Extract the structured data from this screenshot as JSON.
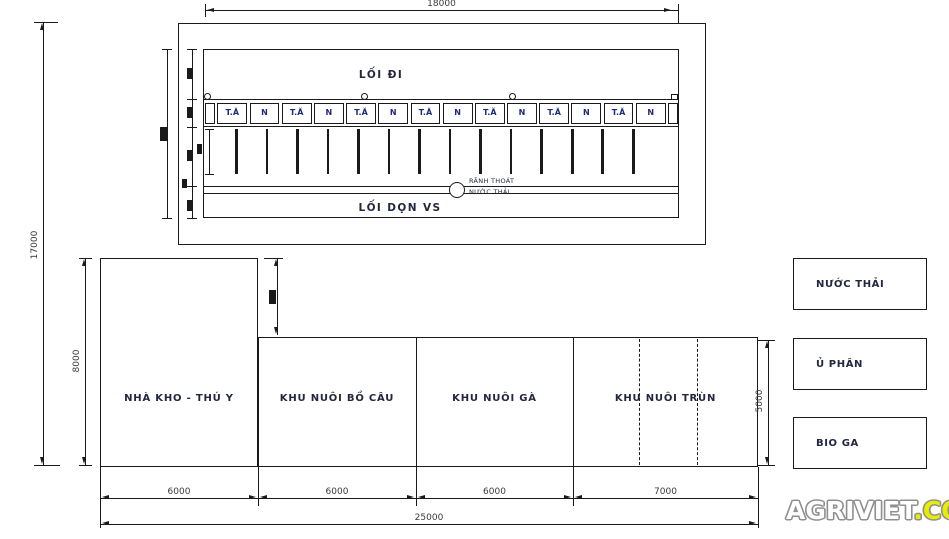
{
  "top_building": {
    "width_dim": "18000",
    "front_walkway": "LỐI ĐI",
    "cells": [
      "T.Ă",
      "N",
      "T.Ă",
      "N",
      "T.Ă",
      "N",
      "T.Ă",
      "N",
      "T.Ă",
      "N",
      "T.Ă",
      "N",
      "T.Ă",
      "N"
    ],
    "drain_line1": "RÃNH THOÁT",
    "drain_line2": "NƯỚC THẢI",
    "back_walkway": "LỐI DỌN VS"
  },
  "site": {
    "overall_height": "17000",
    "warehouse_height": "8000",
    "row_height": "5000",
    "segment_widths": [
      "6000",
      "6000",
      "6000",
      "7000"
    ],
    "overall_width": "25000",
    "buildings": [
      "NHÀ KHO - THÚ Y",
      "KHU NUÔI BỒ CÂU",
      "KHU NUÔI GÀ",
      "KHU NUÔI TRÙN"
    ]
  },
  "facilities": [
    "NƯỚC THẢI",
    "Ủ PHÂN",
    "BIO GA"
  ],
  "logo": {
    "name": "AGRIVIET",
    "tld": ".COM",
    "name_color": "#ffffff",
    "tld_color": "#e8ec00",
    "outline_color": "#8f8f8f"
  },
  "colors": {
    "line": "#1a1a1a",
    "label": "#23263f",
    "cell_label": "#1e2a7a",
    "dimension": "#3a3a3a"
  }
}
